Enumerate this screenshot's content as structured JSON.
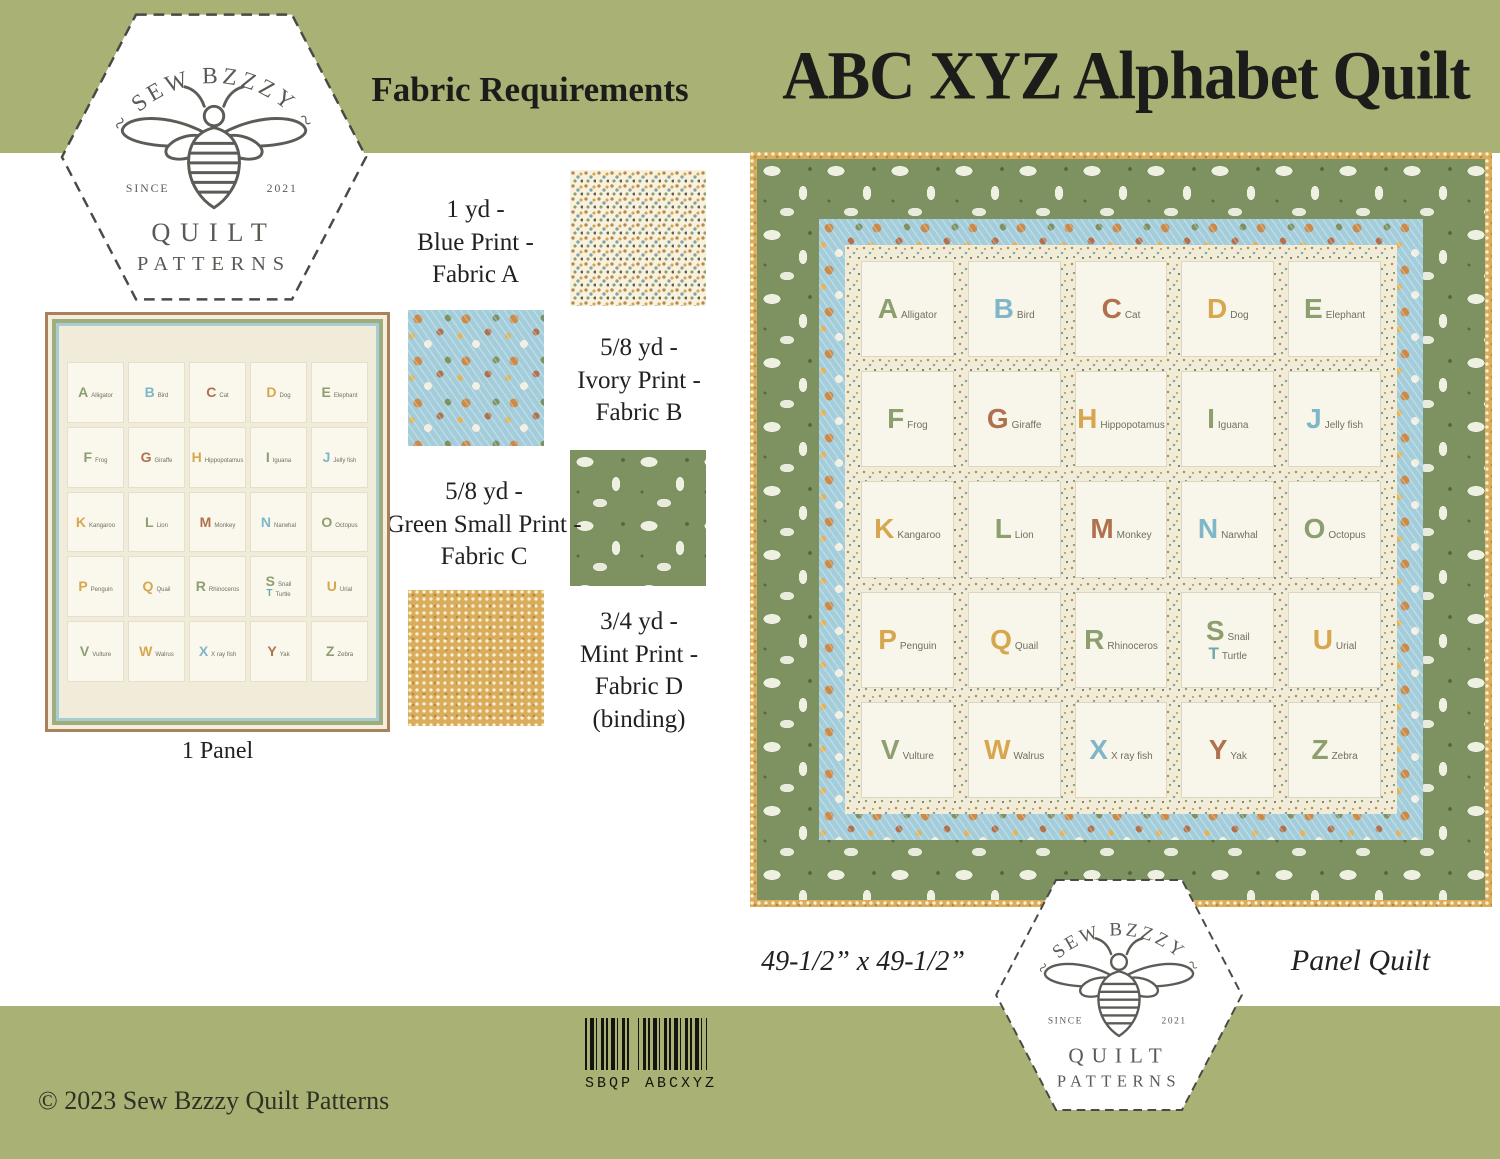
{
  "title": "ABC XYZ Alphabet Quilt",
  "palette": [
    "#8d9e6f",
    "#7fb7c8",
    "#b0714e",
    "#d7a74f",
    "#6fa8ab"
  ],
  "colors": {
    "band_green": "#a9b274",
    "quilt_border_green": "#7d9161",
    "quilt_border_blue": "#a3cdda",
    "quilt_border_gold": "#d9ad5c",
    "panel_border_brown": "#a9815b",
    "cream_field": "#f1ecd8",
    "ink": "#1c1c1a"
  },
  "logo": {
    "brand_arc": "~ SEW BZZZY ~",
    "since_label": "SINCE",
    "year": "2021",
    "word1": "QUILT",
    "word2": "PATTERNS"
  },
  "fabric_requirements": {
    "heading": "Fabric Requirements",
    "fabrics": [
      {
        "amount": "1 yd -",
        "name": "Blue Print -",
        "fabric": "Fabric A",
        "note": ""
      },
      {
        "amount": "5/8 yd -",
        "name": "Ivory Print -",
        "fabric": "Fabric B",
        "note": ""
      },
      {
        "amount": "5/8 yd -",
        "name": "Green Small Print -",
        "fabric": "Fabric C",
        "note": ""
      },
      {
        "amount": "3/4 yd -",
        "name": "Mint Print -",
        "fabric": "Fabric D",
        "note": "(binding)"
      }
    ]
  },
  "panel": {
    "caption": "1 Panel"
  },
  "quilt": {
    "dimensions": "49-1/2” x 49-1/2”",
    "type": "Panel Quilt"
  },
  "footer": {
    "barcode_text": "SBQP ABCXYZ",
    "copyright": "© 2023 Sew Bzzzy Quilt Patterns"
  },
  "alphabet": [
    "A",
    "B",
    "C",
    "D",
    "E",
    "F",
    "G",
    "H",
    "I",
    "J",
    "K",
    "L",
    "M",
    "N",
    "O",
    "P",
    "Q",
    "R",
    "S",
    "T",
    "U",
    "V",
    "W",
    "X",
    "Y",
    "Z"
  ],
  "blocks": [
    {
      "letter": "A",
      "word": "Alligator",
      "color": "#8d9e6f"
    },
    {
      "letter": "B",
      "word": "Bird",
      "color": "#7fb7c8"
    },
    {
      "letter": "C",
      "word": "Cat",
      "color": "#b0714e"
    },
    {
      "letter": "D",
      "word": "Dog",
      "color": "#d7a74f"
    },
    {
      "letter": "E",
      "word": "Elephant",
      "color": "#8d9e6f"
    },
    {
      "letter": "F",
      "word": "Frog",
      "color": "#8d9e6f"
    },
    {
      "letter": "G",
      "word": "Giraffe",
      "color": "#b0714e"
    },
    {
      "letter": "H",
      "word": "Hippopotamus",
      "color": "#d7a74f"
    },
    {
      "letter": "I",
      "word": "Iguana",
      "color": "#8d9e6f"
    },
    {
      "letter": "J",
      "word": "Jelly fish",
      "color": "#7fb7c8"
    },
    {
      "letter": "K",
      "word": "Kangaroo",
      "color": "#d7a74f"
    },
    {
      "letter": "L",
      "word": "Lion",
      "color": "#8d9e6f"
    },
    {
      "letter": "M",
      "word": "Monkey",
      "color": "#b0714e"
    },
    {
      "letter": "N",
      "word": "Narwhal",
      "color": "#7fb7c8"
    },
    {
      "letter": "O",
      "word": "Octopus",
      "color": "#8d9e6f"
    },
    {
      "letter": "P",
      "word": "Penguin",
      "color": "#d7a74f"
    },
    {
      "letter": "Q",
      "word": "Quail",
      "color": "#d7a74f"
    },
    {
      "letter": "R",
      "word": "Rhinoceros",
      "color": "#8d9e6f"
    },
    {
      "letter": "S",
      "word": "Snail",
      "letter2": "T",
      "word2": "Turtle",
      "color": "#8d9e6f"
    },
    {
      "letter": "U",
      "word": "Urial",
      "color": "#d7a74f"
    },
    {
      "letter": "V",
      "word": "Vulture",
      "color": "#8d9e6f"
    },
    {
      "letter": "W",
      "word": "Walrus",
      "color": "#d7a74f"
    },
    {
      "letter": "X",
      "word": "X ray fish",
      "color": "#7fb7c8"
    },
    {
      "letter": "Y",
      "word": "Yak",
      "color": "#b0714e"
    },
    {
      "letter": "Z",
      "word": "Zebra",
      "color": "#8d9e6f"
    }
  ]
}
